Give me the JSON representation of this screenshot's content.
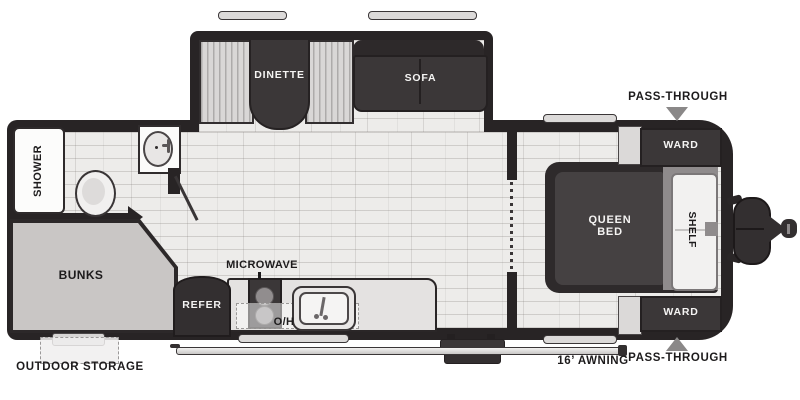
{
  "diagram_type": "travel-trailer-floorplan",
  "labels": {
    "shower": "SHOWER",
    "bunks": "BUNKS",
    "outdoor_storage": "OUTDOOR STORAGE",
    "dinette": "DINETTE",
    "sofa": "SOFA",
    "refer": "REFER",
    "microwave": "MICROWAVE",
    "overhead": "O/H",
    "queen_bed": "QUEEN BED",
    "shelf": "SHELF",
    "ward_top": "WARD",
    "ward_bottom": "WARD",
    "pass_through_top": "PASS-THROUGH",
    "pass_through_bottom": "PASS-THROUGH",
    "awning": "16’ AWNING"
  },
  "colors": {
    "wall": "#282425",
    "floor": "#edecea",
    "furniture_dark": "#3b3738",
    "furniture_darker": "#2d292a",
    "bench": "#d9d7d6",
    "bunks_pad": "#c9c6c5",
    "bed_head_gray": "#8f8b8c",
    "counter": "#e4e2e1",
    "white_fixture": "#fcfcfb",
    "label_black": "#1d1b1c",
    "label_white": "#f5f4f3",
    "arrow_gray": "#8a8888"
  }
}
